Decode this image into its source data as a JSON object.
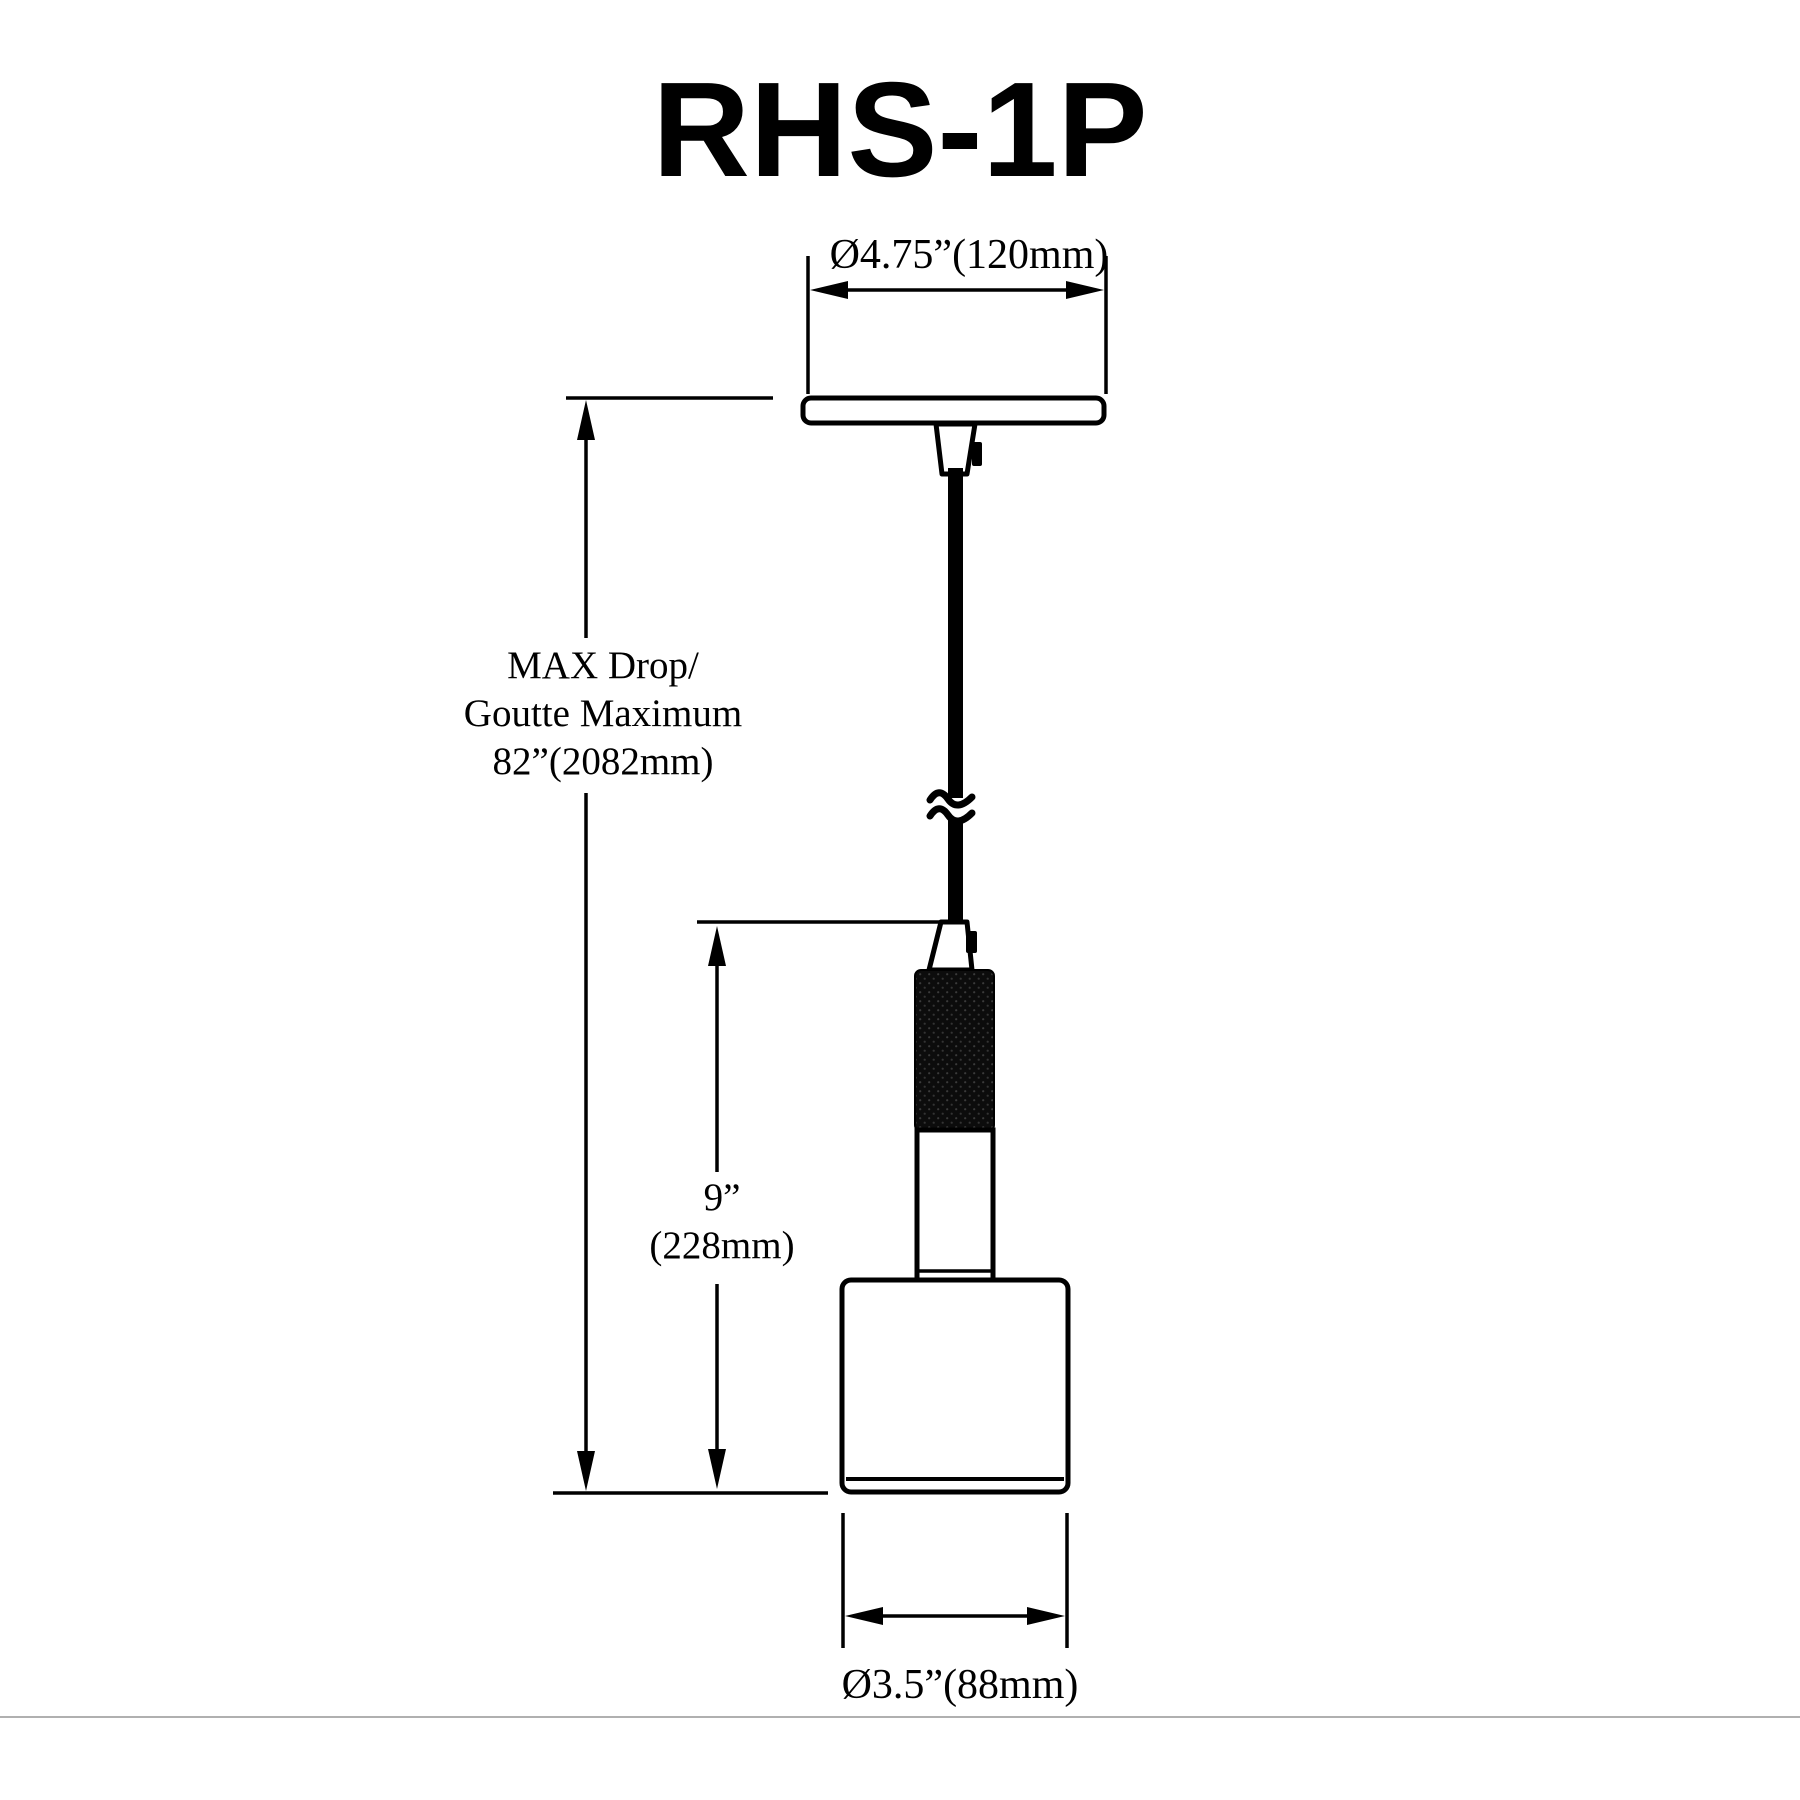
{
  "title": "RHS-1P",
  "drawing": {
    "type": "technical-dimension-diagram",
    "subject": "single-light pendant fixture RHS-1P"
  },
  "dimensions": {
    "canopy": {
      "label": "Ø4.75”(120mm)"
    },
    "max_drop": {
      "lines": [
        "MAX Drop/",
        "Goutte Maximum",
        "82”(2082mm)"
      ]
    },
    "fixture_body": {
      "lines": [
        "9”",
        "(228mm)"
      ]
    },
    "shade": {
      "label": "Ø3.5”(88mm)"
    }
  },
  "colors": {
    "ink": "#000000",
    "background": "#ffffff",
    "separator": "#b0b0b0"
  }
}
